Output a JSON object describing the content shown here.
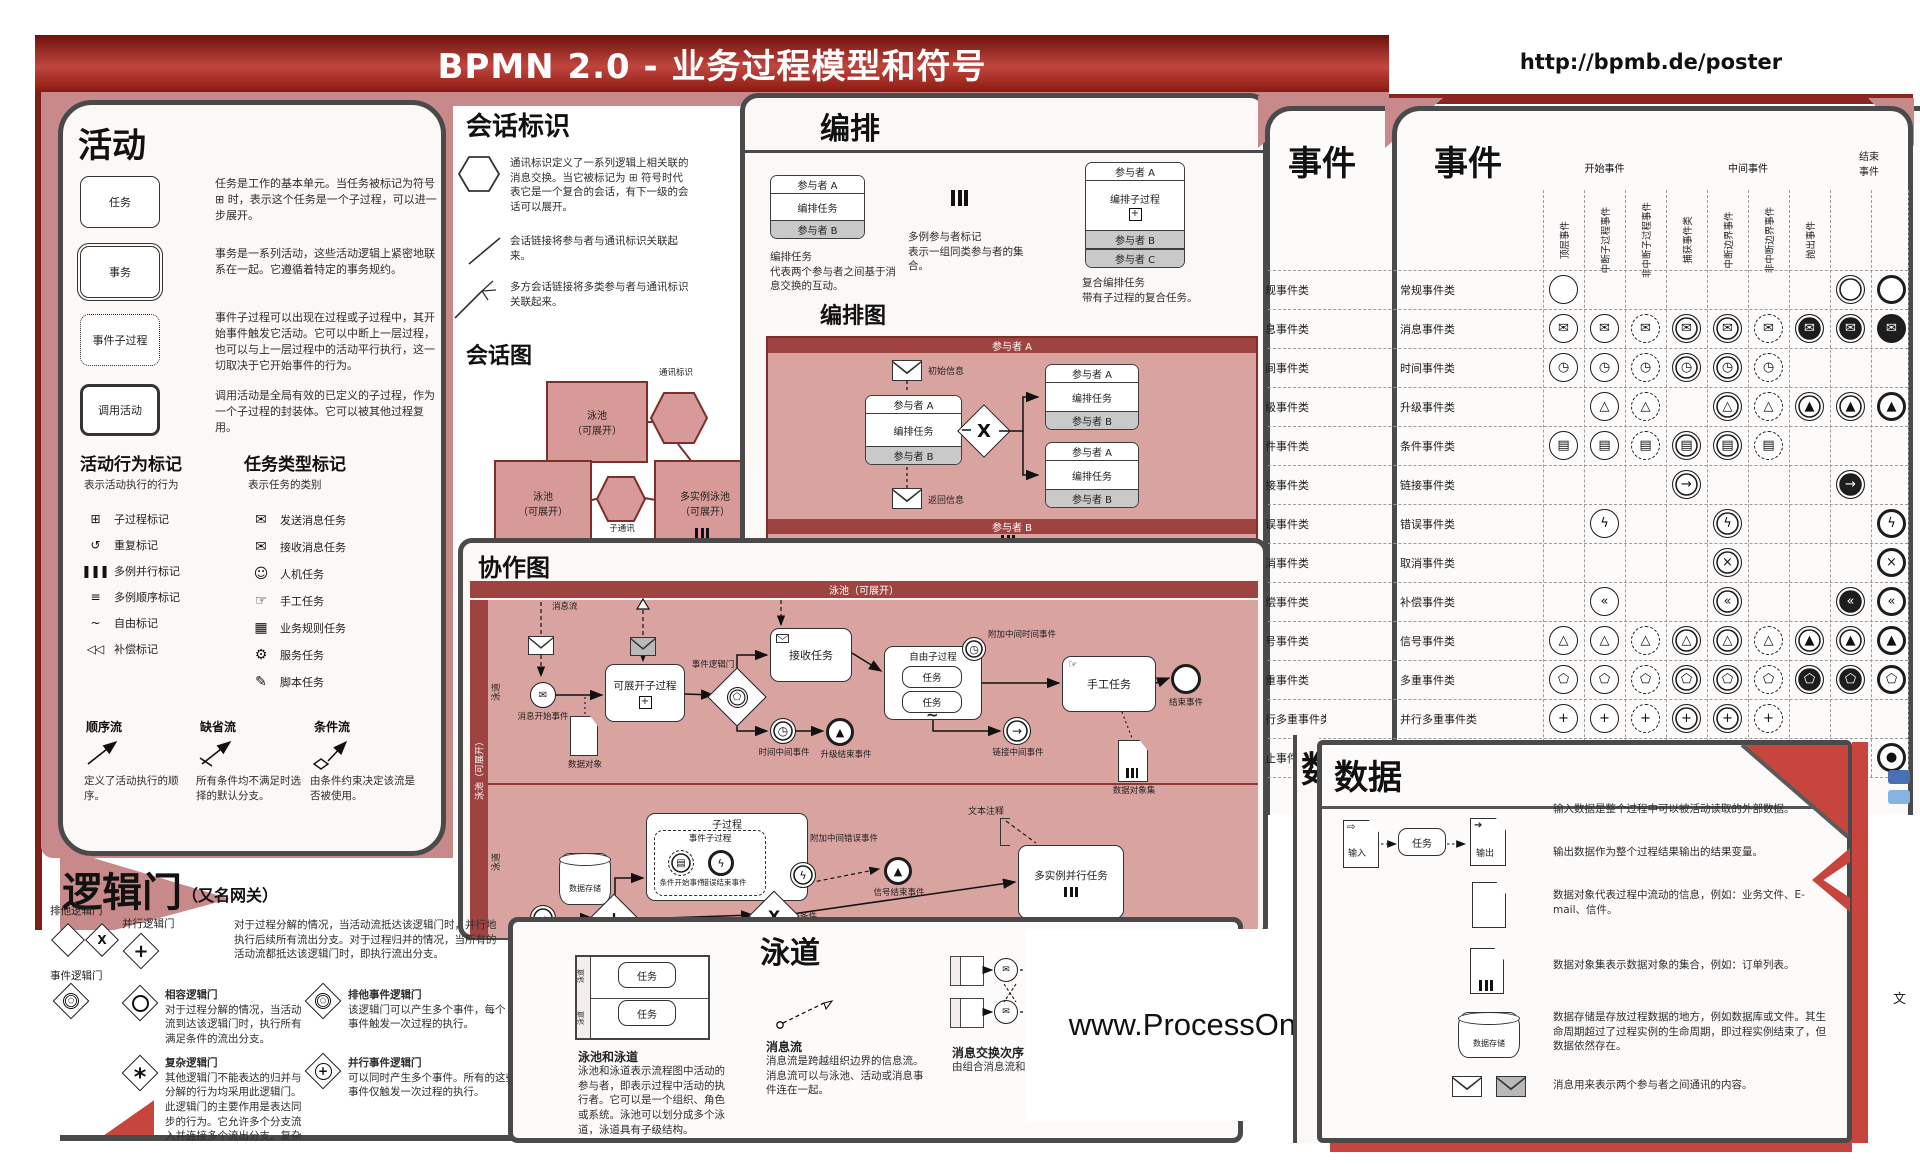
{
  "title": "BPMN 2.0 - 业务过程模型和符号",
  "url": "http://bpmb.de/poster",
  "watermark": "www.ProcessOn.com",
  "activities": {
    "header": "活动",
    "items": [
      {
        "label": "任务",
        "desc": "任务是工作的基本单元。当任务被标记为符号 ⊞ 时，表示这个任务是一个子过程，可以进一步展开。"
      },
      {
        "label": "事务",
        "desc": "事务是一系列活动，这些活动逻辑上紧密地联系在一起。它遵循着特定的事务规约。"
      },
      {
        "label": "事件子过程",
        "desc": "事件子过程可以出现在过程或子过程中，其开始事件触发它活动。它可以中断上一层过程，也可以与上一层过程中的活动平行执行，这一切取决于它开始事件的行为。"
      },
      {
        "label": "调用活动",
        "desc": "调用活动是全局有效的已定义的子过程，作为一个子过程的封装体。它可以被其他过程复用。"
      }
    ],
    "behavior": {
      "header": "活动行为标记",
      "caption": "表示活动执行的行为",
      "items": [
        {
          "icon": "⊞",
          "label": "子过程标记"
        },
        {
          "icon": "↺",
          "label": "重复标记"
        },
        {
          "icon": "❚❚❚",
          "label": "多例并行标记"
        },
        {
          "icon": "≡",
          "label": "多例顺序标记"
        },
        {
          "icon": "~",
          "label": "自由标记"
        },
        {
          "icon": "◁◁",
          "label": "补偿标记"
        }
      ]
    },
    "tasktypes": {
      "header": "任务类型标记",
      "caption": "表示任务的类别",
      "items": [
        {
          "icon": "✉",
          "label": "发送消息任务"
        },
        {
          "icon": "✉",
          "label": "接收消息任务"
        },
        {
          "icon": "☺",
          "label": "人机任务"
        },
        {
          "icon": "☞",
          "label": "手工任务"
        },
        {
          "icon": "▦",
          "label": "业务规则任务"
        },
        {
          "icon": "⚙",
          "label": "服务任务"
        },
        {
          "icon": "✎",
          "label": "脚本任务"
        }
      ]
    },
    "flows": [
      {
        "name": "顺序流",
        "desc": "定义了活动执行的顺序。"
      },
      {
        "name": "缺省流",
        "desc": "所有条件均不满足时选择的默认分支。"
      },
      {
        "name": "条件流",
        "desc": "由条件约束决定该流是否被使用。"
      }
    ]
  },
  "conversation": {
    "header": "会话标识",
    "items": [
      {
        "desc": "通讯标识定义了一系列逻辑上相关联的消息交换。当它被标记为 ⊞ 符号时代表它是一个复合的会话，有下一级的会话可以展开。"
      },
      {
        "desc": "会话链接将参与者与通讯标识关联起来。"
      },
      {
        "desc": "多方会话链接将多类参与者与通讯标识关联起来。"
      }
    ],
    "subheader": "会话图",
    "diagram": {
      "pool1": "泳池\n（可展开）",
      "hex1": "通讯标识",
      "pool2": "泳池\n（可展开）",
      "hex2": "子通讯",
      "pool3": "多实例泳池\n（可展开）"
    }
  },
  "choreography": {
    "header": "编排",
    "task_box": {
      "top": "参与者 A",
      "mid": "编排任务",
      "bottom": "参与者 B"
    },
    "task_caption": "编排任务\n代表两个参与者之间基于消息交换的互动。",
    "multi_caption": "多例参与者标记\n表示一组同类参与者的集合。",
    "sub_box": {
      "top": "参与者 A",
      "mid": "编排子过程",
      "b1": "参与者 B",
      "b2": "参与者 C"
    },
    "sub_caption": "复合编排任务\n带有子过程的复合任务。",
    "subheader": "编排图",
    "diagram": {
      "pool_top": "参与者 A",
      "msg1": "初始信息",
      "msg2": "返回信息",
      "box1": {
        "top": "参与者 A",
        "mid": "编排任务",
        "bottom": "参与者 B"
      },
      "box2": {
        "top": "参与者 A",
        "mid": "编排任务",
        "bottom": "参与者 B"
      },
      "box3": {
        "top": "参与者 A",
        "mid": "编排任务",
        "bottom": "参与者 B"
      },
      "band1": "参与者 B",
      "band2": "参与者 C"
    }
  },
  "events": {
    "header_left": "事件",
    "header_right": "事件",
    "groups": [
      "开始事件",
      "中间事件",
      "结束\n事件"
    ],
    "columns": [
      "顶层事件",
      "中断子过程事件",
      "非中断子过程事件",
      "捕获事件类",
      "中断边界事件",
      "非中断边界事件",
      "抛出事件"
    ],
    "rows": [
      {
        "label": "常规事件类",
        "cells": [
          {
            "cls": "ec",
            "g": ""
          },
          {
            "cls": "ec none",
            "g": ""
          },
          {
            "cls": "ec none",
            "g": ""
          },
          {
            "cls": "ec none",
            "g": ""
          },
          {
            "cls": "ec none",
            "g": ""
          },
          {
            "cls": "ec none",
            "g": ""
          },
          {
            "cls": "ec none",
            "g": ""
          },
          {
            "cls": "ec db",
            "g": ""
          },
          {
            "cls": "ec thk",
            "g": ""
          }
        ]
      },
      {
        "label": "消息事件类",
        "cells": [
          {
            "cls": "ec",
            "g": "✉"
          },
          {
            "cls": "ec",
            "g": "✉"
          },
          {
            "cls": "ec dsh",
            "g": "✉"
          },
          {
            "cls": "ec db",
            "g": "✉"
          },
          {
            "cls": "ec db",
            "g": "✉"
          },
          {
            "cls": "ec dsh",
            "g": "✉"
          },
          {
            "cls": "ec db inv",
            "g": "✉"
          },
          {
            "cls": "ec db inv",
            "g": "✉"
          },
          {
            "cls": "ec thk inv",
            "g": "✉"
          }
        ]
      },
      {
        "label": "时间事件类",
        "cells": [
          {
            "cls": "ec",
            "g": "◷"
          },
          {
            "cls": "ec",
            "g": "◷"
          },
          {
            "cls": "ec dsh",
            "g": "◷"
          },
          {
            "cls": "ec db",
            "g": "◷"
          },
          {
            "cls": "ec db",
            "g": "◷"
          },
          {
            "cls": "ec dsh",
            "g": "◷"
          },
          {
            "cls": "ec none",
            "g": ""
          },
          {
            "cls": "ec none",
            "g": ""
          },
          {
            "cls": "ec none",
            "g": ""
          }
        ]
      },
      {
        "label": "升级事件类",
        "cells": [
          {
            "cls": "ec none",
            "g": ""
          },
          {
            "cls": "ec",
            "g": "△"
          },
          {
            "cls": "ec dsh",
            "g": "△"
          },
          {
            "cls": "ec none",
            "g": ""
          },
          {
            "cls": "ec db",
            "g": "△"
          },
          {
            "cls": "ec dsh",
            "g": "△"
          },
          {
            "cls": "ec db",
            "g": "▲"
          },
          {
            "cls": "ec db",
            "g": "▲"
          },
          {
            "cls": "ec thk",
            "g": "▲"
          }
        ]
      },
      {
        "label": "条件事件类",
        "cells": [
          {
            "cls": "ec",
            "g": "▤"
          },
          {
            "cls": "ec",
            "g": "▤"
          },
          {
            "cls": "ec dsh",
            "g": "▤"
          },
          {
            "cls": "ec db",
            "g": "▤"
          },
          {
            "cls": "ec db",
            "g": "▤"
          },
          {
            "cls": "ec dsh",
            "g": "▤"
          },
          {
            "cls": "ec none",
            "g": ""
          },
          {
            "cls": "ec none",
            "g": ""
          },
          {
            "cls": "ec none",
            "g": ""
          }
        ]
      },
      {
        "label": "链接事件类",
        "cells": [
          {
            "cls": "ec none",
            "g": ""
          },
          {
            "cls": "ec none",
            "g": ""
          },
          {
            "cls": "ec none",
            "g": ""
          },
          {
            "cls": "ec db",
            "g": "→"
          },
          {
            "cls": "ec none",
            "g": ""
          },
          {
            "cls": "ec none",
            "g": ""
          },
          {
            "cls": "ec none",
            "g": ""
          },
          {
            "cls": "ec db inv",
            "g": "→"
          },
          {
            "cls": "ec none",
            "g": ""
          }
        ]
      },
      {
        "label": "错误事件类",
        "cells": [
          {
            "cls": "ec none",
            "g": ""
          },
          {
            "cls": "ec",
            "g": "ϟ"
          },
          {
            "cls": "ec none",
            "g": ""
          },
          {
            "cls": "ec none",
            "g": ""
          },
          {
            "cls": "ec db",
            "g": "ϟ"
          },
          {
            "cls": "ec none",
            "g": ""
          },
          {
            "cls": "ec none",
            "g": ""
          },
          {
            "cls": "ec none",
            "g": ""
          },
          {
            "cls": "ec thk",
            "g": "ϟ"
          }
        ]
      },
      {
        "label": "取消事件类",
        "cells": [
          {
            "cls": "ec none",
            "g": ""
          },
          {
            "cls": "ec none",
            "g": ""
          },
          {
            "cls": "ec none",
            "g": ""
          },
          {
            "cls": "ec none",
            "g": ""
          },
          {
            "cls": "ec db",
            "g": "×"
          },
          {
            "cls": "ec none",
            "g": ""
          },
          {
            "cls": "ec none",
            "g": ""
          },
          {
            "cls": "ec none",
            "g": ""
          },
          {
            "cls": "ec thk",
            "g": "×"
          }
        ]
      },
      {
        "label": "补偿事件类",
        "cells": [
          {
            "cls": "ec none",
            "g": ""
          },
          {
            "cls": "ec",
            "g": "«"
          },
          {
            "cls": "ec none",
            "g": ""
          },
          {
            "cls": "ec none",
            "g": ""
          },
          {
            "cls": "ec db",
            "g": "«"
          },
          {
            "cls": "ec none",
            "g": ""
          },
          {
            "cls": "ec none",
            "g": ""
          },
          {
            "cls": "ec db inv",
            "g": "«"
          },
          {
            "cls": "ec thk",
            "g": "«"
          }
        ]
      },
      {
        "label": "信号事件类",
        "cells": [
          {
            "cls": "ec",
            "g": "△"
          },
          {
            "cls": "ec",
            "g": "△"
          },
          {
            "cls": "ec dsh",
            "g": "△"
          },
          {
            "cls": "ec db",
            "g": "△"
          },
          {
            "cls": "ec db",
            "g": "△"
          },
          {
            "cls": "ec dsh",
            "g": "△"
          },
          {
            "cls": "ec db",
            "g": "▲"
          },
          {
            "cls": "ec db",
            "g": "▲"
          },
          {
            "cls": "ec thk",
            "g": "▲"
          }
        ]
      },
      {
        "label": "多重事件类",
        "cells": [
          {
            "cls": "ec",
            "g": "⬠"
          },
          {
            "cls": "ec",
            "g": "⬠"
          },
          {
            "cls": "ec dsh",
            "g": "⬠"
          },
          {
            "cls": "ec db",
            "g": "⬠"
          },
          {
            "cls": "ec db",
            "g": "⬠"
          },
          {
            "cls": "ec dsh",
            "g": "⬠"
          },
          {
            "cls": "ec db inv",
            "g": "⬠"
          },
          {
            "cls": "ec db inv",
            "g": "⬠"
          },
          {
            "cls": "ec thk",
            "g": "⬠"
          }
        ]
      },
      {
        "label": "并行多重事件类",
        "cells": [
          {
            "cls": "ec",
            "g": "+"
          },
          {
            "cls": "ec",
            "g": "+"
          },
          {
            "cls": "ec dsh",
            "g": "+"
          },
          {
            "cls": "ec db",
            "g": "+"
          },
          {
            "cls": "ec db",
            "g": "+"
          },
          {
            "cls": "ec dsh",
            "g": "+"
          },
          {
            "cls": "ec none",
            "g": ""
          },
          {
            "cls": "ec none",
            "g": ""
          },
          {
            "cls": "ec none",
            "g": ""
          }
        ]
      },
      {
        "label": "终止事件类",
        "cells": [
          {
            "cls": "ec none",
            "g": ""
          },
          {
            "cls": "ec none",
            "g": ""
          },
          {
            "cls": "ec none",
            "g": ""
          },
          {
            "cls": "ec none",
            "g": ""
          },
          {
            "cls": "ec none",
            "g": ""
          },
          {
            "cls": "ec none",
            "g": ""
          },
          {
            "cls": "ec none",
            "g": ""
          },
          {
            "cls": "ec none",
            "g": ""
          },
          {
            "cls": "ec thk",
            "g": "●"
          }
        ]
      }
    ]
  },
  "collaboration": {
    "header": "协作图",
    "pool": "泳池（可展开）",
    "pool_side": "泳池（可展开）",
    "lane": "泳道",
    "labels": {
      "msgflow": "消息流",
      "msg_start": "消息开始事件",
      "data_object": "数据对象",
      "expandable": "可展开子过程",
      "event_gw": "事件逻辑门",
      "receive": "接收任务",
      "timer": "时间中间事件",
      "escalation_end": "升级结束事件",
      "adhoc": "自由子过程",
      "task1": "任务",
      "task2": "任务",
      "attached_timer": "附加中间时间事件",
      "manual": "手工任务",
      "end": "结束事件",
      "link": "链接中间事件",
      "data_collection": "数据对象集",
      "data_store": "数据存储",
      "subprocess": "子过程",
      "event_sub": "事件子过程",
      "cond_start": "条件开始事件",
      "error_end": "错误结束事件",
      "attached_error": "附加中间错误事件",
      "signal_end": "信号结束事件",
      "annotation": "文本注释",
      "multi_task": "多实例并行任务",
      "condition": "条件"
    }
  },
  "swimlanes": {
    "header": "泳道",
    "lane_task": "任务",
    "s1": {
      "name": "泳池和泳道",
      "desc": "泳池和泳道表示流程图中活动的参与者，即表示过程中活动的执行者。它可以是一个组织、角色或系统。泳池可以划分成多个泳道，泳道具有子级结构。"
    },
    "s2": {
      "name": "消息流",
      "desc": "消息流是跨越组织边界的信息流。消息流可以与泳池、活动或消息事件连在一起。"
    },
    "s3": {
      "name": "消息交换次序",
      "desc": "由组合消息流和顺序流决定。"
    }
  },
  "data_panel": {
    "header": "数据",
    "flow": {
      "in": "输入",
      "task": "任务",
      "out": "输出"
    },
    "store_label": "数据存储",
    "items": [
      "输入数据是整个过程中可以被活动读取的外部数据。",
      "输出数据作为整个过程结果输出的结果变量。",
      "数据对象代表过程中流动的信息，例如：业务文件、E-mail、信件。",
      "数据对象集表示数据对象的集合，例如：订单列表。",
      "数据存储是存放过程数据的地方，例如数据库或文件。其生命周期超过了过程实例的生命周期，即过程实例结束了，但数据依然存在。",
      "消息用来表示两个参与者之间通讯的内容。"
    ],
    "fragment": "数据",
    "fragment2": "文"
  },
  "gateways": {
    "header": "逻辑门",
    "subtitle": "（又名网关）",
    "left": [
      {
        "label": "排他逻辑门"
      },
      {
        "label": "事件逻辑门"
      }
    ],
    "parallel": {
      "name": "并行逻辑门",
      "desc": "对于过程分解的情况，当活动流抵达该逻辑门时，并行地执行后续所有流出分支。对于过程归并的情况，当所有的活动流都抵达该逻辑门时，即执行流出分支。"
    },
    "inclusive": {
      "name": "相容逻辑门",
      "desc": "对于过程分解的情况，当活动流到达该逻辑门时，执行所有满足条件的流出分支。"
    },
    "exclusive_event": {
      "name": "排他事件逻辑门",
      "desc": "该逻辑门可以产生多个事件，每个事件触发一次过程的执行。"
    },
    "complex": {
      "name": "复杂逻辑门",
      "desc": "其他逻辑门不能表达的归并与分解的行为均采用此逻辑门。此逻辑门的主要作用是表达同步的行为。它允许多个分支流入并连接多个流出分支。复杂"
    },
    "parallel_event": {
      "name": "并行事件逻辑门",
      "desc": "可以同时产生多个事件。所有的这些事件仅触发一次过程的执行。"
    }
  }
}
